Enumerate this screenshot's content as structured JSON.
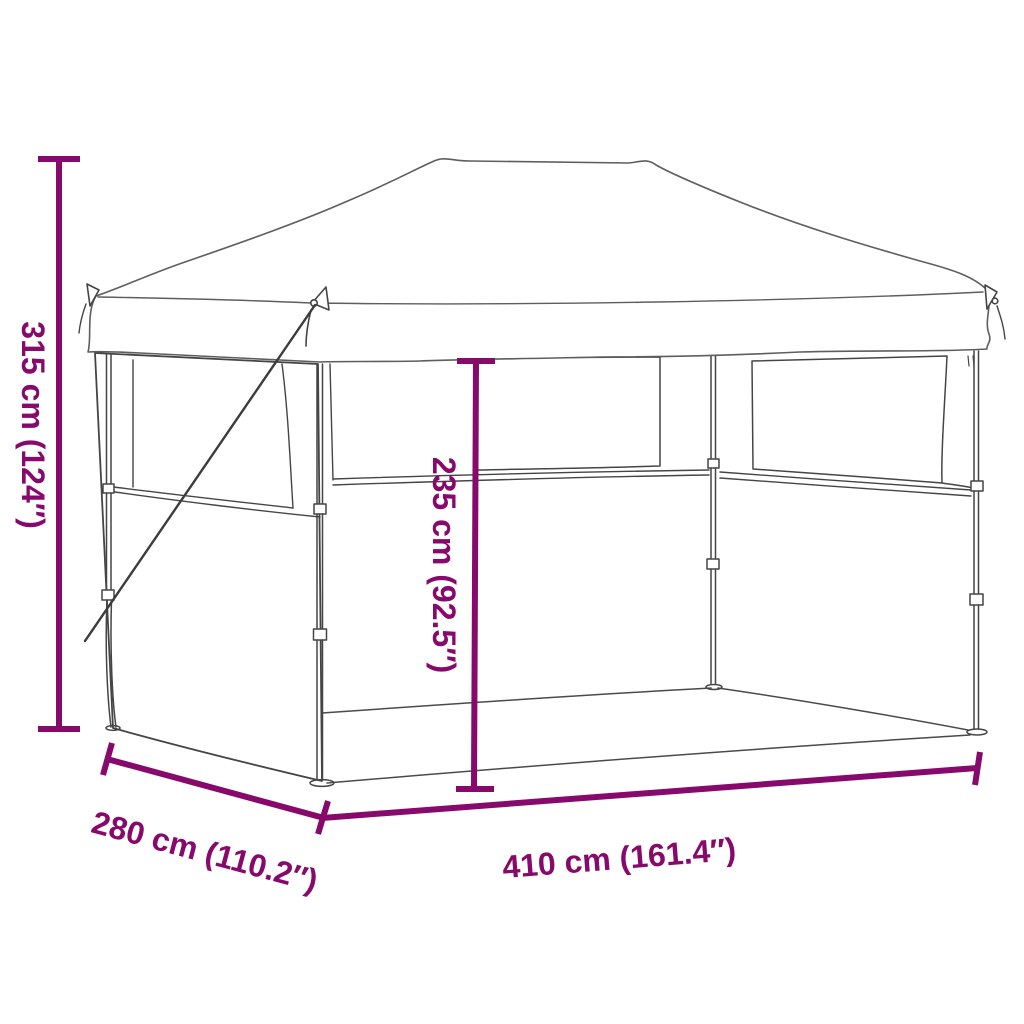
{
  "figure": {
    "subject": "pop-up folding party tent (gazebo) with sidewalls - product dimension diagram",
    "background_color": "#ffffff",
    "tent_line_color": "#454545",
    "canopy_line_color": "#5e5e5e",
    "accent_color": "#87096B",
    "dimensions": {
      "total_height": {
        "label": "315 cm (124″)",
        "orientation": "vertical-left"
      },
      "inner_height": {
        "label": "235 cm (92.5″)",
        "orientation": "vertical-center"
      },
      "depth": {
        "label": "280 cm (110.2″)",
        "orientation": "diagonal-bottom-left"
      },
      "width": {
        "label": "410 cm (161.4″)",
        "orientation": "horizontal-bottom"
      }
    }
  }
}
